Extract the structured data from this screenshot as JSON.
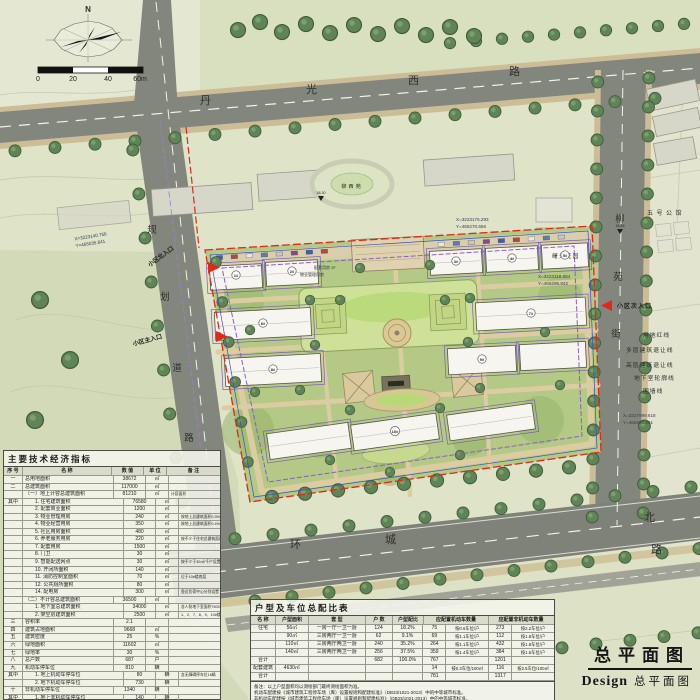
{
  "compass": {
    "north_label": "N"
  },
  "scalebar": {
    "labels": [
      "0",
      "20",
      "40",
      "60m"
    ]
  },
  "roads": {
    "top": {
      "name": "丹光西路",
      "chars": [
        "丹",
        "光",
        "西",
        "路"
      ]
    },
    "left": {
      "name": "规划道路",
      "chars": [
        "规",
        "划",
        "道",
        "路"
      ]
    },
    "right": {
      "name": "柳苑街",
      "chars": [
        "柳",
        "苑",
        "街"
      ]
    },
    "bottom": {
      "name": "环城北路",
      "chars": [
        "环",
        "城",
        "北",
        "路"
      ]
    }
  },
  "places": [
    {
      "name": "柳西苑"
    },
    {
      "name": "五号公馆"
    },
    {
      "name": "曙光花园"
    }
  ],
  "entrances": [
    {
      "label": "小区北入口"
    },
    {
      "label": "小区主入口"
    },
    {
      "label": "小区次入口"
    }
  ],
  "legend": {
    "items": [
      "用地红线",
      "多层建筑退让线",
      "高层建筑退让线",
      "地下室轮廓线",
      "围墙线"
    ]
  },
  "coordinates": [
    {
      "x": "X=3223140.756",
      "y": "Y=465035.841"
    },
    {
      "x": "X=3223175.293",
      "y": "Y=465270.656"
    },
    {
      "x": "X=3223118.084",
      "y": "Y=465295.842"
    },
    {
      "x": "X=3227999.618",
      "y": "Y=465290.091"
    }
  ],
  "spot_elevations": [
    "18.45",
    "18.30"
  ],
  "site_labels": [
    {
      "t": "配套用房 2F"
    },
    {
      "t": "物业管理用房"
    }
  ],
  "building_tags": [
    "1#",
    "2#",
    "3#",
    "4#",
    "5#",
    "6#",
    "7#",
    "8#",
    "9#",
    "10#"
  ],
  "econ_table": {
    "title": "主要技术经济指标",
    "headers": [
      "序 号",
      "名 称",
      "数 值",
      "单 位",
      "备 注"
    ],
    "rows": [
      [
        "一",
        "总用地面积",
        "38672",
        "㎡",
        "",
        0
      ],
      [
        "二",
        "总建筑面积",
        "117000",
        "㎡",
        "",
        0
      ],
      [
        "",
        "（一）地上计容总建筑面积",
        "81210",
        "㎡",
        "计容面积",
        0
      ],
      [
        "其中",
        "1. 住宅建筑面积",
        "76580",
        "㎡",
        "",
        1
      ],
      [
        "",
        "2. 配套商业面积",
        "1200",
        "㎡",
        "",
        1
      ],
      [
        "",
        "3. 物业管理用房",
        "240",
        "㎡",
        "按地上总建筑面积0.3%设置",
        1
      ],
      [
        "",
        "4. 物业经营用房",
        "350",
        "㎡",
        "按地上总建筑面积0.4%设置",
        1
      ],
      [
        "",
        "5. 社区用房面积",
        "480",
        "㎡",
        "",
        1
      ],
      [
        "",
        "6. 养老服务用房",
        "220",
        "㎡",
        "按不少于住宅总建筑面积的2‰",
        1
      ],
      [
        "",
        "7. 配套用房",
        "1500",
        "㎡",
        "",
        1
      ],
      [
        "",
        "8. 门卫",
        "30",
        "㎡",
        "",
        1
      ],
      [
        "",
        "9. 智能配送网点",
        "30",
        "㎡",
        "按不少于30㎡/千户设置",
        1
      ],
      [
        "",
        "10. 开闭所面积",
        "140",
        "㎡",
        "",
        1
      ],
      [
        "",
        "11. 消防控制室面积",
        "70",
        "㎡",
        "位于10#楼底层",
        1
      ],
      [
        "",
        "12. 公共厕所面积",
        "80",
        "㎡",
        "",
        1
      ],
      [
        "",
        "14. 配电房",
        "300",
        "㎡",
        "靠近负荷中心分别设置",
        1
      ],
      [
        "",
        "（二）不计容总建筑面积",
        "36500",
        "㎡",
        "",
        0
      ],
      [
        "",
        "1. 地下室总建筑面积",
        "34000",
        "㎡",
        "含人防地下室面积7500㎡",
        1
      ],
      [
        "",
        "2. 架空层建筑面积",
        "2500",
        "㎡",
        "1、2、7、8、9、10#楼",
        1
      ],
      [
        "三",
        "容积率",
        "2.1",
        "",
        "",
        0
      ],
      [
        "四",
        "建筑占地面积",
        "9668",
        "㎡",
        "",
        0
      ],
      [
        "五",
        "建筑密度",
        "25",
        "%",
        "",
        0
      ],
      [
        "六",
        "绿地面积",
        "11602",
        "㎡",
        "",
        0
      ],
      [
        "七",
        "绿地率",
        "30",
        "%",
        "",
        0
      ],
      [
        "八",
        "总户数",
        "687",
        "户",
        "",
        0
      ],
      [
        "九",
        "机动车停车位",
        "810",
        "辆",
        "",
        0
      ],
      [
        "其中",
        "1. 地上机动车停车位",
        "80",
        "辆",
        "含无障碍停车位16辆",
        1
      ],
      [
        "",
        "2. 地下机动车停车位",
        "730",
        "辆",
        "",
        1
      ],
      [
        "十",
        "非机动车停车位",
        "1340",
        "辆",
        "",
        0
      ],
      [
        "其中",
        "1. 地上非机动车停车位",
        "140",
        "辆",
        "",
        1
      ],
      [
        "",
        "2. 地下非机动车停车位",
        "1200",
        "辆",
        "",
        1
      ]
    ]
  },
  "parking_table": {
    "title": "户型及车位总配比表",
    "headers": [
      "名 称",
      "户型面积",
      "套 型",
      "户 数",
      "户型配比",
      "应配置机动车数量",
      "应配置非机动车数量"
    ],
    "rows": [
      [
        "住宅",
        "56㎡",
        "一房一厅一卫一厨",
        "124",
        "18.2%",
        "75",
        "按0.6车位/户",
        "273",
        "按2.2车位/户"
      ],
      [
        "",
        "90㎡",
        "三房两厅一卫一厨",
        "62",
        "9.1%",
        "69",
        "按1.1车位/户",
        "112",
        "按1.8车位/户"
      ],
      [
        "",
        "110㎡",
        "三房两厅两卫一厨",
        "240",
        "35.2%",
        "264",
        "按1.1车位/户",
        "432",
        "按1.8车位/户"
      ],
      [
        "",
        "140㎡",
        "三房两厅两卫一厨",
        "256",
        "37.5%",
        "359",
        "按1.4车位/户",
        "384",
        "按1.5车位/户"
      ],
      [
        "合计",
        "",
        "",
        "682",
        "100.0%",
        "767",
        "",
        "1201",
        ""
      ],
      [
        "配套建筑",
        "4630㎡",
        "",
        "",
        "",
        "14",
        "按0.3车位/100㎡",
        "116",
        "按2.5车位/100㎡"
      ],
      [
        "合计",
        "",
        "",
        "",
        "",
        "781",
        "",
        "1317",
        ""
      ]
    ],
    "notes": [
      "备注：以上户型面积均以测绘部门最终测绘面积为准。",
      "机动车配建按《城市建筑工程停车场（库）设置规则和配建标准》（DB33/1021-2013）中的中等城市标准。",
      "非机动车配建按《城市建筑工程停车场（库）设置规则和配建标准》（DB33/1021-2013）中的中等城市标准。"
    ]
  },
  "title_block": {
    "main": "总平面图",
    "en": "Design",
    "sub": "总平面图"
  },
  "colors": {
    "boundary_red": "#e02818",
    "setback_purple": "#8a5fc0",
    "fence_blue": "#3c50bb",
    "road_gray": "#83867c",
    "site_green": "#b3c985"
  }
}
